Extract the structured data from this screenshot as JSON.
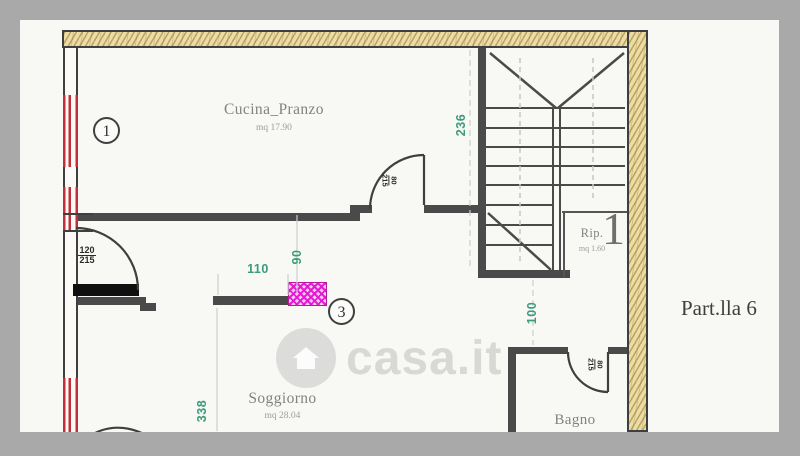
{
  "plan": {
    "rooms": {
      "cucina": {
        "name": "Cucina_Pranzo",
        "area": "mq 17.90"
      },
      "soggiorno": {
        "name": "Soggiorno",
        "area": "mq 28.04"
      },
      "rip": {
        "name": "Rip.",
        "area": "mq 1.60"
      },
      "bagno": {
        "name": "Bagno"
      }
    },
    "dimensions": {
      "stairwell_width": "236",
      "kitchen_opening": "90",
      "new_wall_length": "110",
      "corridor_width": "100",
      "soggiorno_side": "338"
    },
    "doors": {
      "entry": {
        "w": "120",
        "h": "215"
      },
      "kitchen": {
        "w": "80",
        "h": "215"
      },
      "bagno": {
        "w": "80",
        "h": "215"
      }
    },
    "markers": {
      "circle_1": "1",
      "circle_3": "3",
      "stair_number": "1"
    },
    "annotation": "Part.lla 6",
    "watermark": {
      "text": "casa.it"
    },
    "colors": {
      "dimension_green": "#3d9b7d",
      "new_wall_magenta": "#e416d4",
      "window_red": "#c22f3a",
      "wall_tan": "#ecdca6",
      "frame_gray": "#a9a9a9"
    }
  }
}
